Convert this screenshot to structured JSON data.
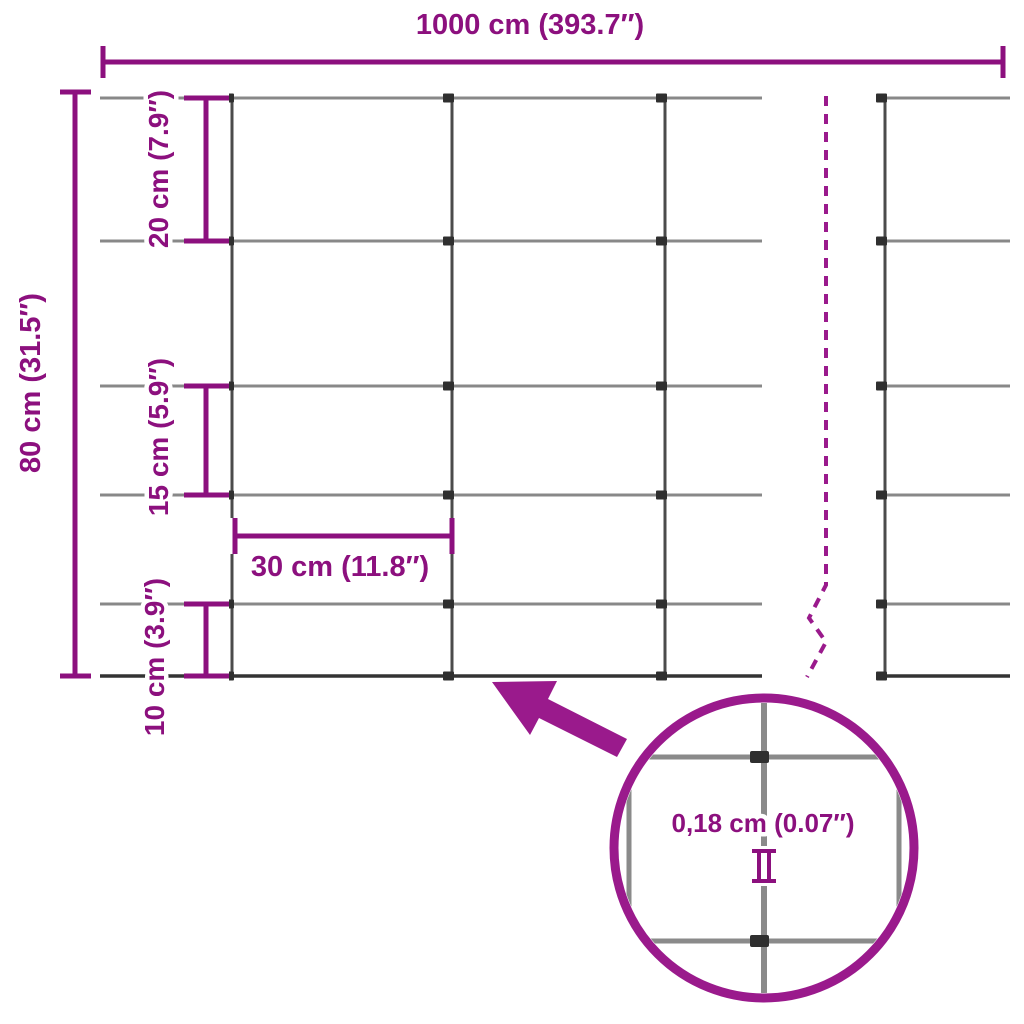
{
  "diagram": {
    "kind": "fence-mesh-dimension-diagram",
    "labels": {
      "total_width": "1000 cm (393.7″)",
      "total_height": "80 cm (31.5″)",
      "row_gap_top": "20 cm (7.9″)",
      "row_gap_middle": "15 cm (5.9″)",
      "row_gap_bottom": "10 cm (3.9″)",
      "column_gap": "30 cm (11.8″)",
      "wire_thickness": "0,18 cm (0.07″)"
    },
    "values": {
      "total_width_cm": 1000,
      "total_width_in": 393.7,
      "total_height_cm": 80,
      "total_height_in": 31.5,
      "row_gaps_cm": [
        20,
        20,
        15,
        15,
        10
      ],
      "column_gap_cm": 30,
      "wire_thickness_cm": 0.18,
      "wire_thickness_in": 0.07
    },
    "colors": {
      "dimension": "#8C107E",
      "accent": "#9A1A8C",
      "wire_horizontal": "#888888",
      "wire_vertical": "#4B4B4B",
      "wire_bottom": "#333333",
      "clamp": "#2F2F2F",
      "background": "#FFFFFF"
    }
  }
}
